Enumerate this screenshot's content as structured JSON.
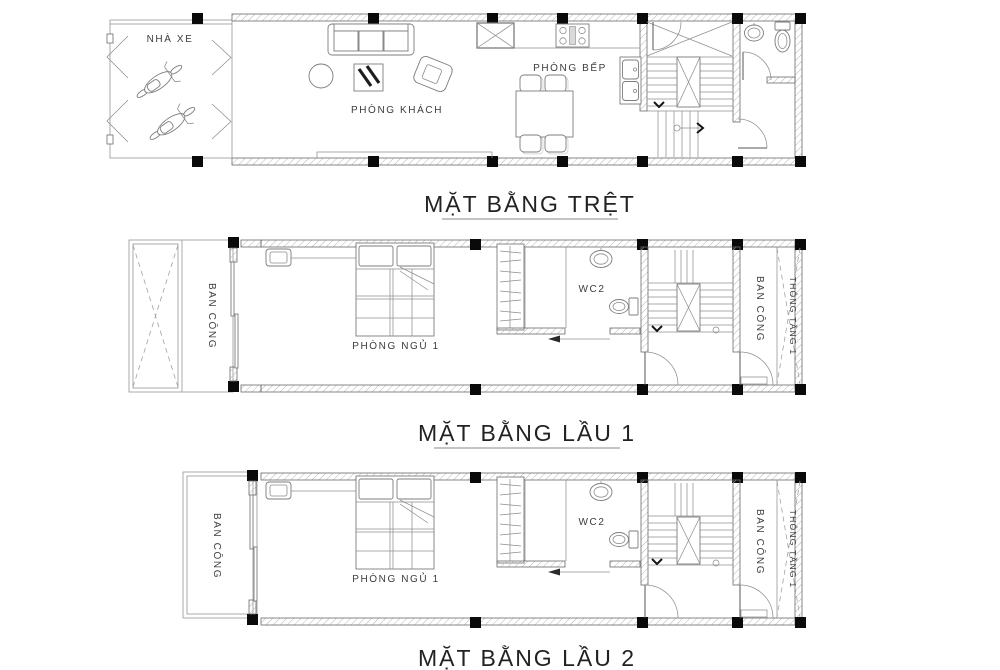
{
  "sheet": {
    "background": "#ffffff",
    "ink": "#565656",
    "column_color": "#0a0a0a"
  },
  "plans": [
    {
      "title": "MẶT BẰNG TRỆT",
      "labels": {
        "garage": "NHÀ XE",
        "living": "PHÒNG KHÁCH",
        "kitchen": "PHÒNG BẾP"
      }
    },
    {
      "title": "MẶT BẰNG LẦU 1",
      "labels": {
        "balcony_front": "BAN CÔNG",
        "bedroom": "PHÒNG NGỦ 1",
        "wc": "WC2",
        "balcony_rear": "BAN CÔNG",
        "void": "THÔNG TẦNG 1"
      }
    },
    {
      "title": "MẶT BẰNG LẦU 2",
      "labels": {
        "balcony_front": "BAN CÔNG",
        "bedroom": "PHÒNG NGỦ 1",
        "wc": "WC2",
        "balcony_rear": "BAN CÔNG",
        "void": "THÔNG TẦNG 1"
      }
    }
  ]
}
